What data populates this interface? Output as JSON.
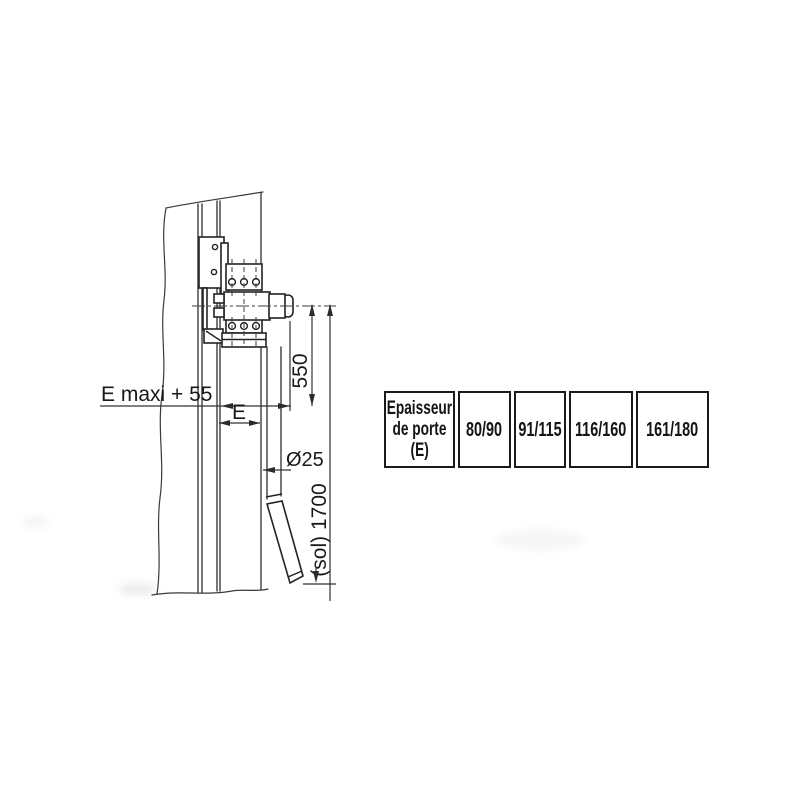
{
  "page": {
    "background": "#ffffff",
    "line_color": "#2e2e2e",
    "text_color": "#191919"
  },
  "drawing": {
    "dims": {
      "e_maxi": "E maxi + 55",
      "e": "E",
      "diameter": "Ø25",
      "axis_to_line": "550",
      "floor_height": "(sol) 1700"
    }
  },
  "table": {
    "header_lines": [
      "Epaisseur",
      "de porte",
      "(E)"
    ],
    "values": [
      "80/90",
      "91/115",
      "116/160",
      "161/180"
    ]
  }
}
